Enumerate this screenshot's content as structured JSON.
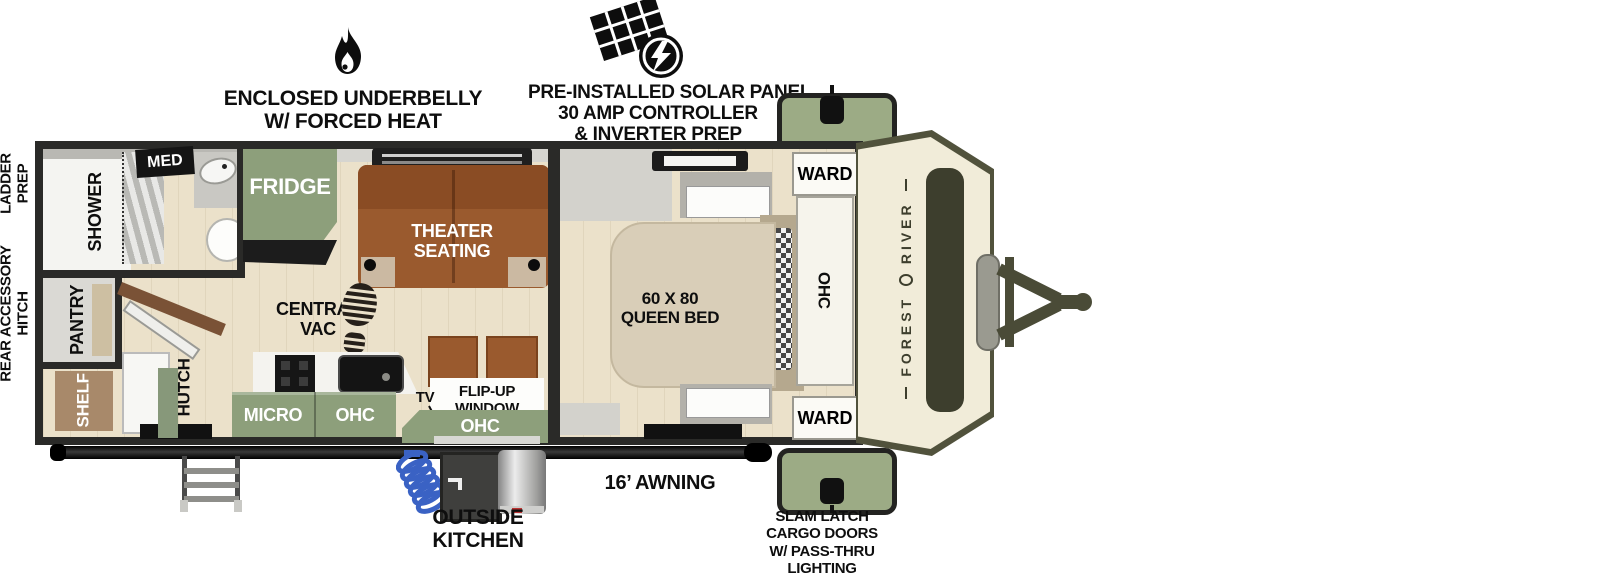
{
  "annotations": {
    "underbelly_line1": "ENCLOSED UNDERBELLY",
    "underbelly_line2": "W/ FORCED HEAT",
    "solar_line1": "PRE-INSTALLED SOLAR PANEL",
    "solar_line2": "30 AMP CONTROLLER",
    "solar_line3": "& INVERTER PREP",
    "ladder_line1": "LADDER",
    "ladder_line2": "PREP",
    "hitch_line1": "REAR ACCESSORY",
    "hitch_line2": "HITCH",
    "awning": "16’ AWNING",
    "outside_line1": "OUTSIDE",
    "outside_line2": "KITCHEN",
    "cargo_line1": "SLAM LATCH",
    "cargo_line2": "CARGO DOORS",
    "cargo_line3": "W/ PASS-THRU",
    "cargo_line4": "LIGHTING"
  },
  "rooms": {
    "med": "MED",
    "shower": "SHOWER",
    "pantry": "PANTRY",
    "shelf": "SHELF",
    "hutch": "HUTCH",
    "fridge": "FRIDGE",
    "theater_line1": "THEATER",
    "theater_line2": "SEATING",
    "vac_line1": "CENTRAL",
    "vac_line2": "VAC",
    "micro": "MICRO",
    "ohc_kitchen": "OHC",
    "tv": "TV",
    "flipup_line1": "FLIP-UP",
    "flipup_line2": "WINDOW",
    "ohc_window": "OHC",
    "bed_line1": "60 X 80",
    "bed_line2": "QUEEN BED",
    "ward_top": "WARD",
    "ohc_bedroom": "OHC",
    "ward_bottom": "WARD",
    "brand_word1": "FOREST",
    "brand_word2": "RIVER"
  },
  "icons": {
    "flame": "flame-icon",
    "solar": "solar-panel-icon",
    "bootprint": "boot-print-icon"
  },
  "colors": {
    "cabinet_sage": "#8d9f7b",
    "cargo_door_green": "#9cab85",
    "sofa_brown": "#9a5a2e",
    "bed_beige": "#d9ceb8",
    "front_cap_cream": "#f1ecd9",
    "olive_trim": "#51523c",
    "wall_dark": "#2a2a28",
    "floor_wood": "#ebe1ca",
    "awning_black": "#0a0a0a",
    "hose_blue": "#3a62c4"
  }
}
